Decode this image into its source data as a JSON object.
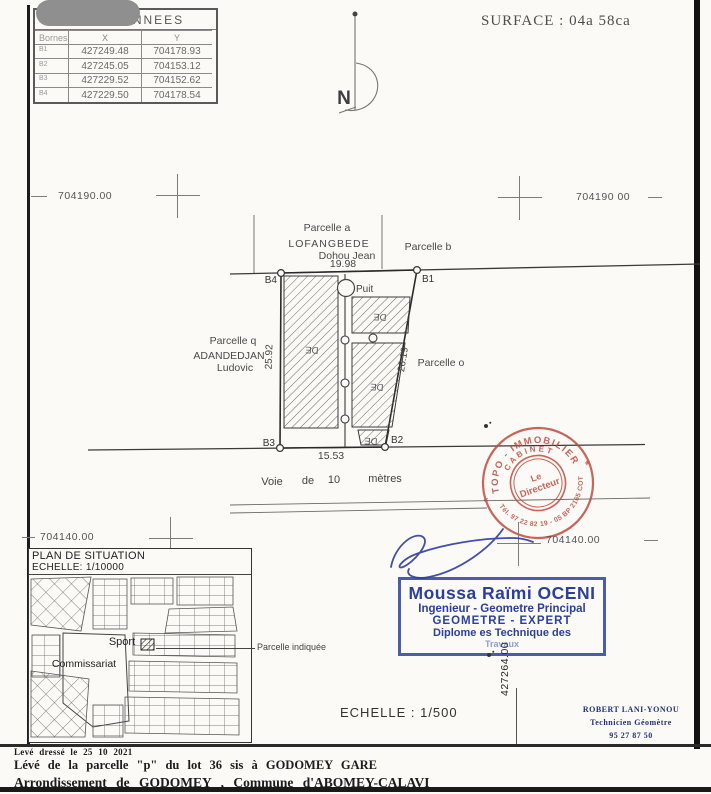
{
  "header": {
    "surface": "SURFACE : 04a 58ca",
    "north_label": "N",
    "coordinates": {
      "title": "COORDONNEES",
      "col_id": "Bornes",
      "col_x": "X",
      "col_y": "Y",
      "rows": [
        {
          "id": "B1",
          "x": "427249.48",
          "y": "704178.93"
        },
        {
          "id": "B2",
          "x": "427245.05",
          "y": "704153.12"
        },
        {
          "id": "B3",
          "x": "427229.52",
          "y": "704152.62"
        },
        {
          "id": "B4",
          "x": "427229.50",
          "y": "704178.54"
        }
      ]
    }
  },
  "grid": {
    "top_left": "704190.00",
    "top_right": "704190 00",
    "bottom_left": "704140.00",
    "bottom_right": "704140.00",
    "vertical": "427264.00"
  },
  "plan": {
    "neighbor_top": {
      "line1": "Parcelle a",
      "line2": "LOFANGBEDE",
      "line3": "Dohou Jean"
    },
    "neighbor_right_top": "Parcelle b",
    "neighbor_left": {
      "line1": "Parcelle q",
      "line2": "ADANDEDJAN",
      "line3": "Ludovic"
    },
    "neighbor_right": "Parcelle o",
    "corners": {
      "b1": "B1",
      "b2": "B2",
      "b3": "B3",
      "b4": "B4"
    },
    "dims": {
      "top": "19.98",
      "left": "25.92",
      "right": "26.19",
      "bottom": "15.53"
    },
    "well": "Puit",
    "subplot": "DE",
    "road": {
      "w1": "Voie",
      "w2": "de",
      "w3": "10",
      "w4": "mètres"
    }
  },
  "situation": {
    "title": "PLAN DE SITUATION",
    "scale": "ECHELLE: 1/10000",
    "sport": "Sport",
    "commissariat": "Commissariat",
    "indicated": "Parcelle indiquée"
  },
  "stamps": {
    "red": {
      "arc_top": "TOPO - IMMOBILIER",
      "arc_mid": "CABINET",
      "center1": "Le",
      "center2": "Directeur",
      "arc_bottom": "Tél. 97 22 82 19 - 05 BP 2165 COT",
      "star_left": "*",
      "star_right": "*"
    },
    "blue": {
      "name": "Moussa Raïmi OCENI",
      "role1": "Ingenieur - Geometre Principal",
      "role2": "GEOMETRE - EXPERT",
      "role3": "Diplome es Technique des",
      "role4": "Travaux"
    },
    "navy": {
      "name": "ROBERT LANI-YONOU",
      "role": "Technicien Géomètre",
      "phone": "95 27 87 50"
    }
  },
  "scale_main": "ECHELLE : 1/500",
  "footer": {
    "line1": "Levé dressé le 25 10 2021",
    "line2": "Lévé de la parcelle \"p\" du lot 36 sis à GODOMEY GARE",
    "line3": "Arrondissement de GODOMEY , Commune d'ABOMEY-CALAVI"
  }
}
